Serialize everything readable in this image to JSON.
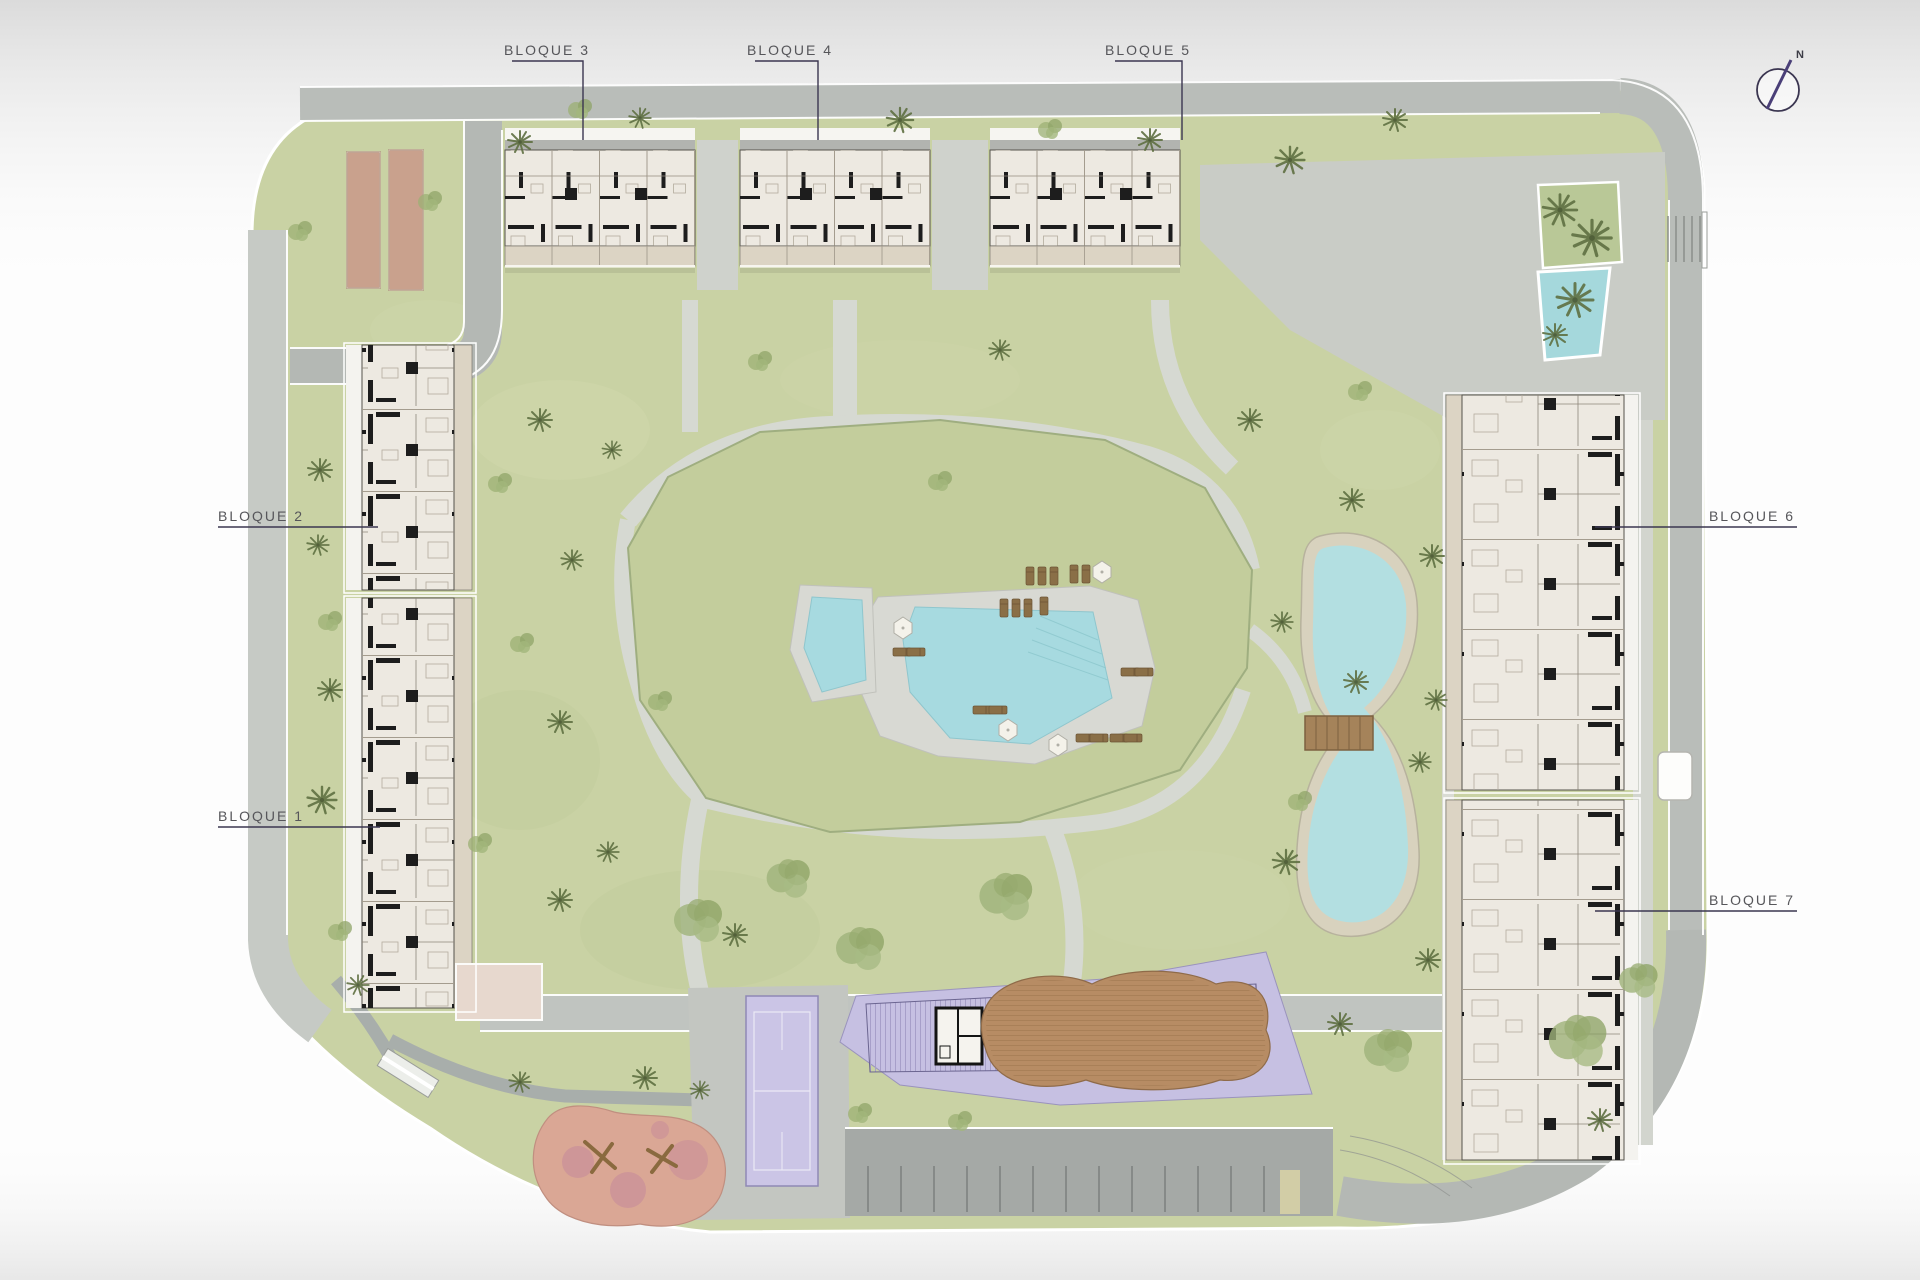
{
  "plan": {
    "labels": {
      "bloque1": {
        "text": "BLOQUE 1"
      },
      "bloque2": {
        "text": "BLOQUE 2"
      },
      "bloque3": {
        "text": "BLOQUE 3"
      },
      "bloque4": {
        "text": "BLOQUE 4"
      },
      "bloque5": {
        "text": "BLOQUE 5"
      },
      "bloque6": {
        "text": "BLOQUE 6"
      },
      "bloque7": {
        "text": "BLOQUE 7"
      }
    },
    "compass": {
      "label": "N"
    },
    "colors": {
      "grass": "#c9d2a4",
      "mound": "#c3cd9c",
      "road": "#b9bdb9",
      "path": "#d6d9d2",
      "pool_water": "#a7dae0",
      "lake_water": "#b3dfe1",
      "lake_stone": "#d8d2be",
      "building": "#EDE9E1",
      "terrace": "#DCD4C4",
      "purple_zone": "#c6c0e2",
      "court": "#cbc5e6",
      "wood_deck": "#b78c64",
      "playground": "#daa795",
      "padel_court": "#c9a18d",
      "leader_line": "#3b3650"
    }
  }
}
